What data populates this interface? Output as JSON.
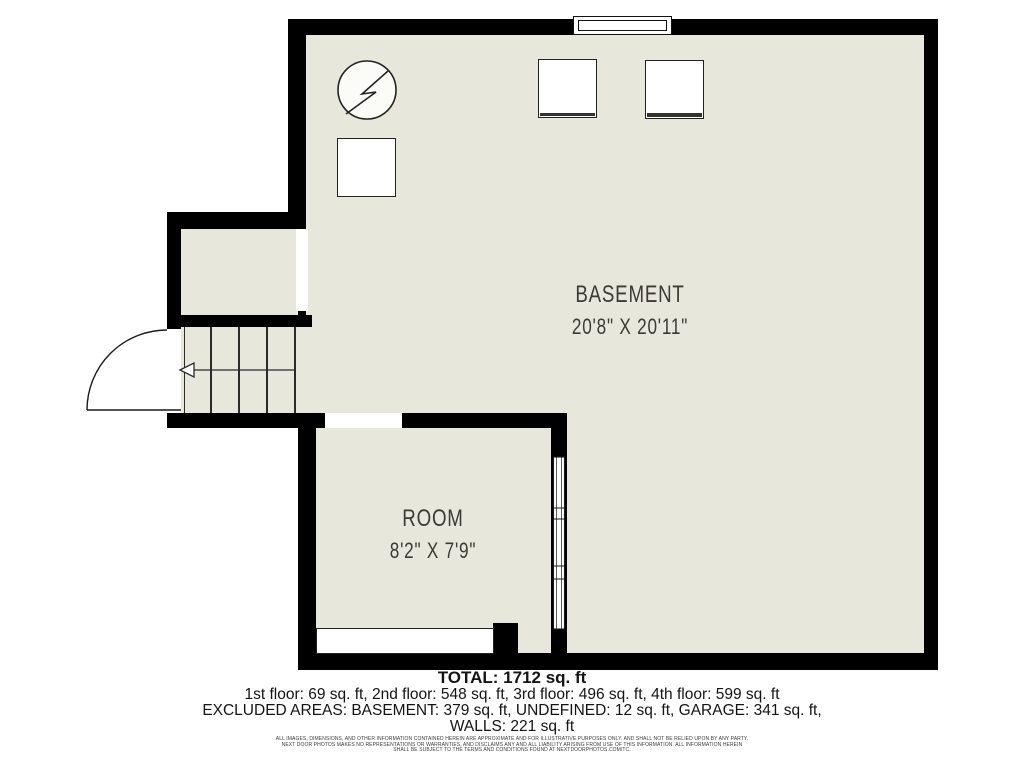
{
  "colors": {
    "wall": "#000000",
    "floor": "#e8e7dc",
    "line": "#222222",
    "room_label": "#3b3a33",
    "summary": "#141414",
    "disclaimer": "#3c3c3c",
    "background": "#ffffff"
  },
  "rooms": [
    {
      "name": "BASEMENT",
      "dims": "20'8\" X 20'11\""
    },
    {
      "name": "ROOM",
      "dims": "8'2\" X 7'9\""
    }
  ],
  "symbols": [
    {
      "name": "electric-water-heater",
      "shape": "circle-with-lightning-bolt"
    },
    {
      "name": "appliance",
      "shape": "square"
    },
    {
      "name": "stairs-down-arrow",
      "shape": "left-arrow"
    }
  ],
  "summary": {
    "total": "TOTAL: 1712 sq. ft",
    "floors": "1st floor: 69 sq. ft, 2nd floor: 548 sq. ft, 3rd floor: 496 sq. ft, 4th floor: 599 sq. ft",
    "excluded": "EXCLUDED AREAS: BASEMENT: 379 sq. ft, UNDEFINED: 12 sq. ft, GARAGE: 341 sq. ft,",
    "walls": "WALLS: 221 sq. ft"
  },
  "disclaimer": {
    "line1": "ALL IMAGES, DIMENSIONS, AND OTHER INFORMATION CONTAINED HEREIN ARE APPROXIMATE AND FOR ILLUSTRATIVE PURPOSES ONLY, AND SHALL NOT BE RELIED UPON BY ANY PARTY.",
    "line2": "NEXT DOOR PHOTOS MAKES NO REPRESENTATIONS OR WARRANTIES, AND DISCLAIMS ANY AND ALL LIABILITY ARISING FROM USE OF THIS INFORMATION. ALL INFORMATION HEREIN",
    "line3": "SHALL BE SUBJECT TO THE TERMS AND CONDITIONS FOUND AT NEXTDOORPHOTOS.COM/TC."
  }
}
